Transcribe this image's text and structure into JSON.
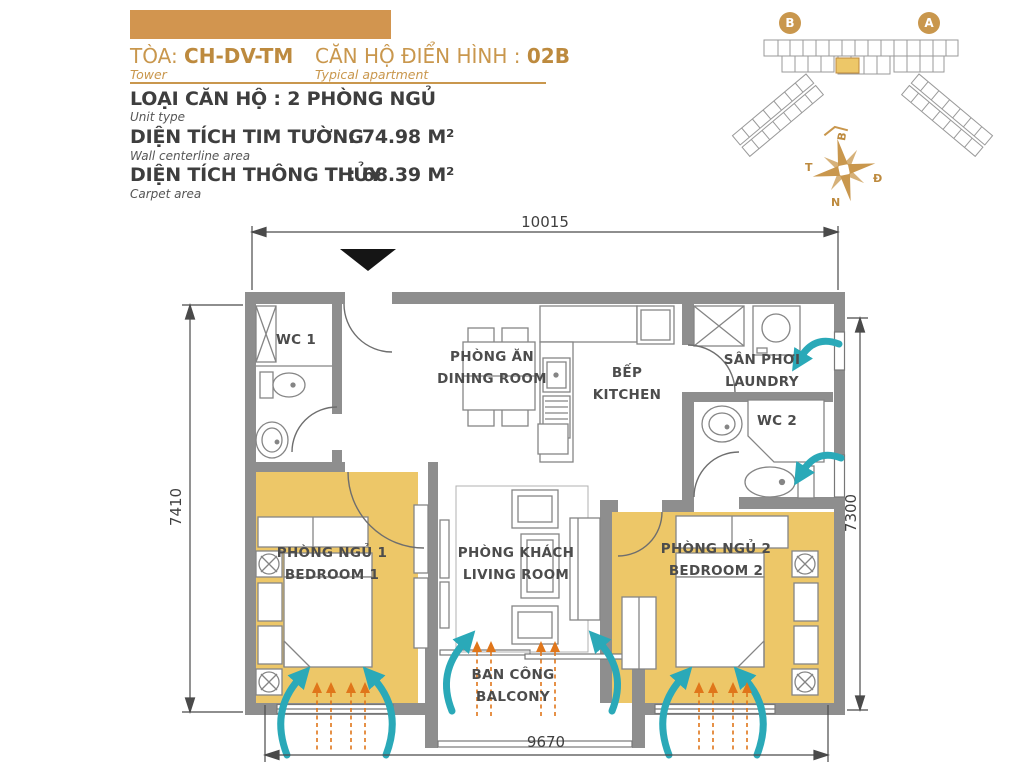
{
  "header": {
    "tower_label": "TÒA:",
    "tower_value": "CH-DV-TM",
    "tower_sub": "Tower",
    "apartment_label": "CĂN HỘ ĐIỂN HÌNH :",
    "apartment_value": "02B",
    "apartment_sub": "Typical apartment",
    "unit_type_line": "LOẠI CĂN HỘ : 2 PHÒNG NGỦ",
    "unit_type_sub": "Unit type",
    "area_wall_label": "DIỆN TÍCH TIM TƯỜNG",
    "area_wall_value": ": 74.98 M²",
    "area_wall_sub": "Wall centerline area",
    "area_carpet_label": "DIỆN TÍCH THÔNG THỦY",
    "area_carpet_value": ": 68.39 M²",
    "area_carpet_sub": "Carpet area"
  },
  "key_plan": {
    "marker_b": "B",
    "marker_a": "A"
  },
  "compass": {
    "north": "B",
    "south": "N",
    "east": "Đ",
    "west": "T"
  },
  "dimensions": {
    "top": "10015",
    "bottom": "9670",
    "left": "7410",
    "right": "7300"
  },
  "rooms": {
    "wc1": {
      "vi": "WC 1"
    },
    "dining": {
      "vi": "PHÒNG ĂN",
      "en": "DINING ROOM"
    },
    "kitchen": {
      "vi": "BẾP",
      "en": "KITCHEN"
    },
    "laundry": {
      "vi": "SÂN PHƠI",
      "en": "LAUNDRY"
    },
    "wc2": {
      "vi": "WC 2"
    },
    "bedroom1": {
      "vi": "PHÒNG NGỦ 1",
      "en": "BEDROOM 1"
    },
    "living": {
      "vi": "PHÒNG KHÁCH",
      "en": "LIVING ROOM"
    },
    "bedroom2": {
      "vi": "PHÒNG NGỦ 2",
      "en": "BEDROOM 2"
    },
    "balcony": {
      "vi": "BAN CÔNG",
      "en": "BALCONY"
    }
  },
  "colors": {
    "accent_gold": "#c9974d",
    "accent_gold_dark": "#bd8a3e",
    "header_bar": "#d2954f",
    "floor_gold": "#edc768",
    "wall_gray": "#8e8e8e",
    "airflow_teal": "#2aa9b8",
    "airflow_orange": "#e0761a",
    "text_dark": "#3e3e3e"
  }
}
